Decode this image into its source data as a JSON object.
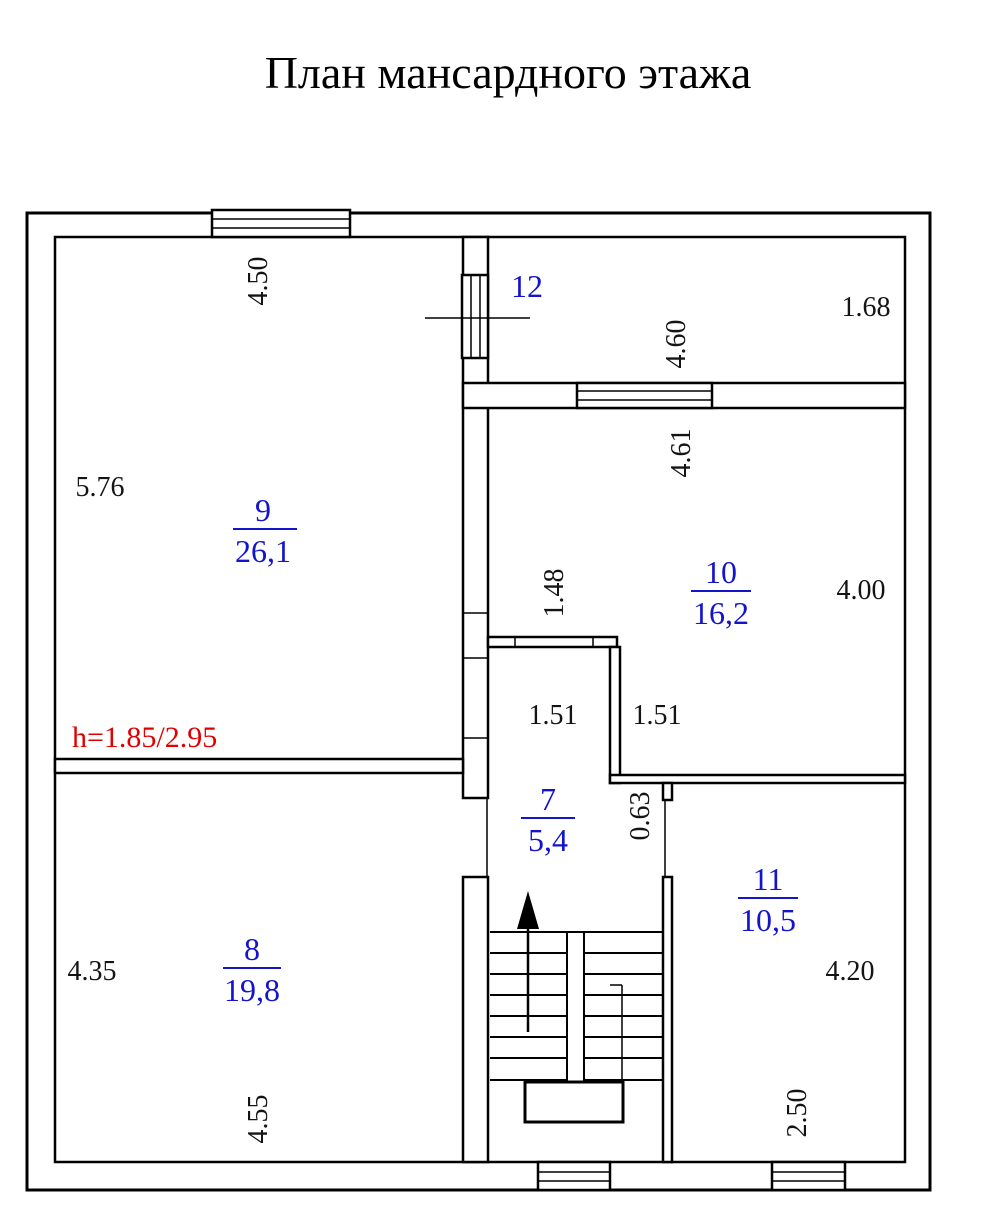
{
  "title": "План мансардного этажа",
  "note": "h=1.85/2.95",
  "colors": {
    "wall": "#000000",
    "room_label": "#1414cc",
    "height_note": "#e00000",
    "dimension": "#141414"
  },
  "rooms": {
    "r7": {
      "number": "7",
      "area": "5,4"
    },
    "r8": {
      "number": "8",
      "area": "19,8"
    },
    "r9": {
      "number": "9",
      "area": "26,1"
    },
    "r10": {
      "number": "10",
      "area": "16,2"
    },
    "r11": {
      "number": "11",
      "area": "10,5"
    },
    "r12": {
      "number": "12",
      "area": ""
    }
  },
  "dims": {
    "room9_top": "4.50",
    "room9_left": "5.76",
    "room12_height": "1.68",
    "room12_width": "4.60",
    "room10_width": "4.61",
    "room10_height": "4.00",
    "corridor_width": "1.48",
    "corridor_left": "1.51",
    "corridor_right": "1.51",
    "passage_width": "0.63",
    "room8_left": "4.35",
    "room8_bottom": "4.55",
    "room11_height": "4.20",
    "room11_width": "2.50"
  }
}
